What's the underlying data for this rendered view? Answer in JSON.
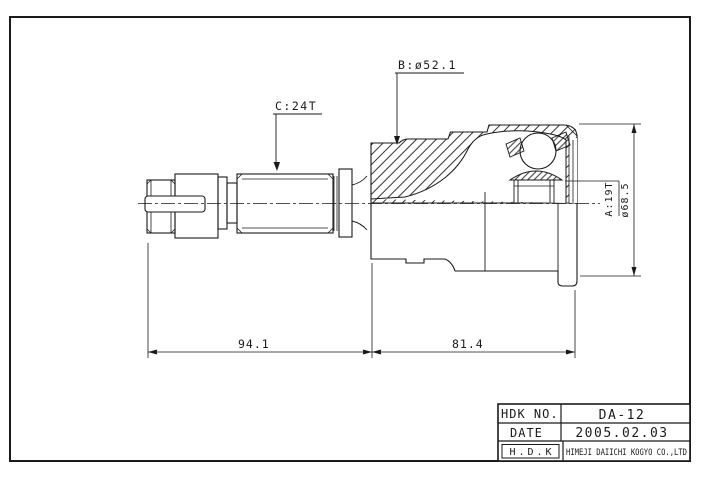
{
  "drawing": {
    "label_b": "B:ø52.1",
    "label_c": "C:24T",
    "label_a": "A:19T",
    "label_dia": "ø68.5",
    "dim_left": "94.1",
    "dim_right": "81.4"
  },
  "title_block": {
    "hdk_no_label": "HDK NO.",
    "hdk_no_value": "DA-12",
    "date_label": "DATE",
    "date_value": "2005.02.03",
    "company_abbr": "H.D.K",
    "company_name": "HIMEJI DAIICHI KOGYO CO.,LTD"
  },
  "colors": {
    "ink": "#1a1a1a",
    "paper": "#ffffff"
  }
}
